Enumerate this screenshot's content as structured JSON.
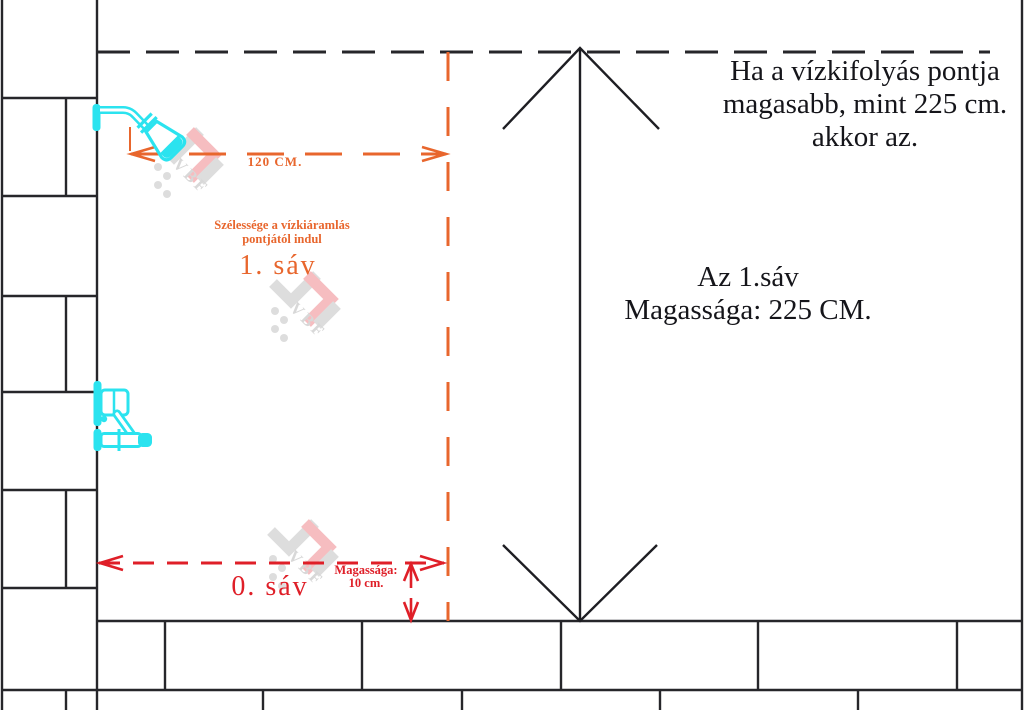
{
  "diagram": {
    "title_note": "Ha a vízkifolyás pontja\nmagasabb, mint 225 cm.\nakkor az.",
    "band1": {
      "height_note": "Az 1.sáv\nMagassága: 225 CM.",
      "width_note": "Szélessége a vízkiáramlás\npontjától indul",
      "label": "1. sáv",
      "width_dim_label": "120 CM."
    },
    "band0": {
      "label": "0. sáv",
      "height_note": "Magassága:\n10 cm."
    },
    "watermark": {
      "text": "VBF"
    },
    "colors": {
      "line_black": "#26262a",
      "text_black": "#15151a",
      "band1_accent_orange": "#e8662d",
      "band0_accent_red": "#df1f28",
      "fixture_cyan": "#2be3ef",
      "watermark_gray": "#c3c3c3",
      "watermark_pink": "#f0888d"
    }
  }
}
